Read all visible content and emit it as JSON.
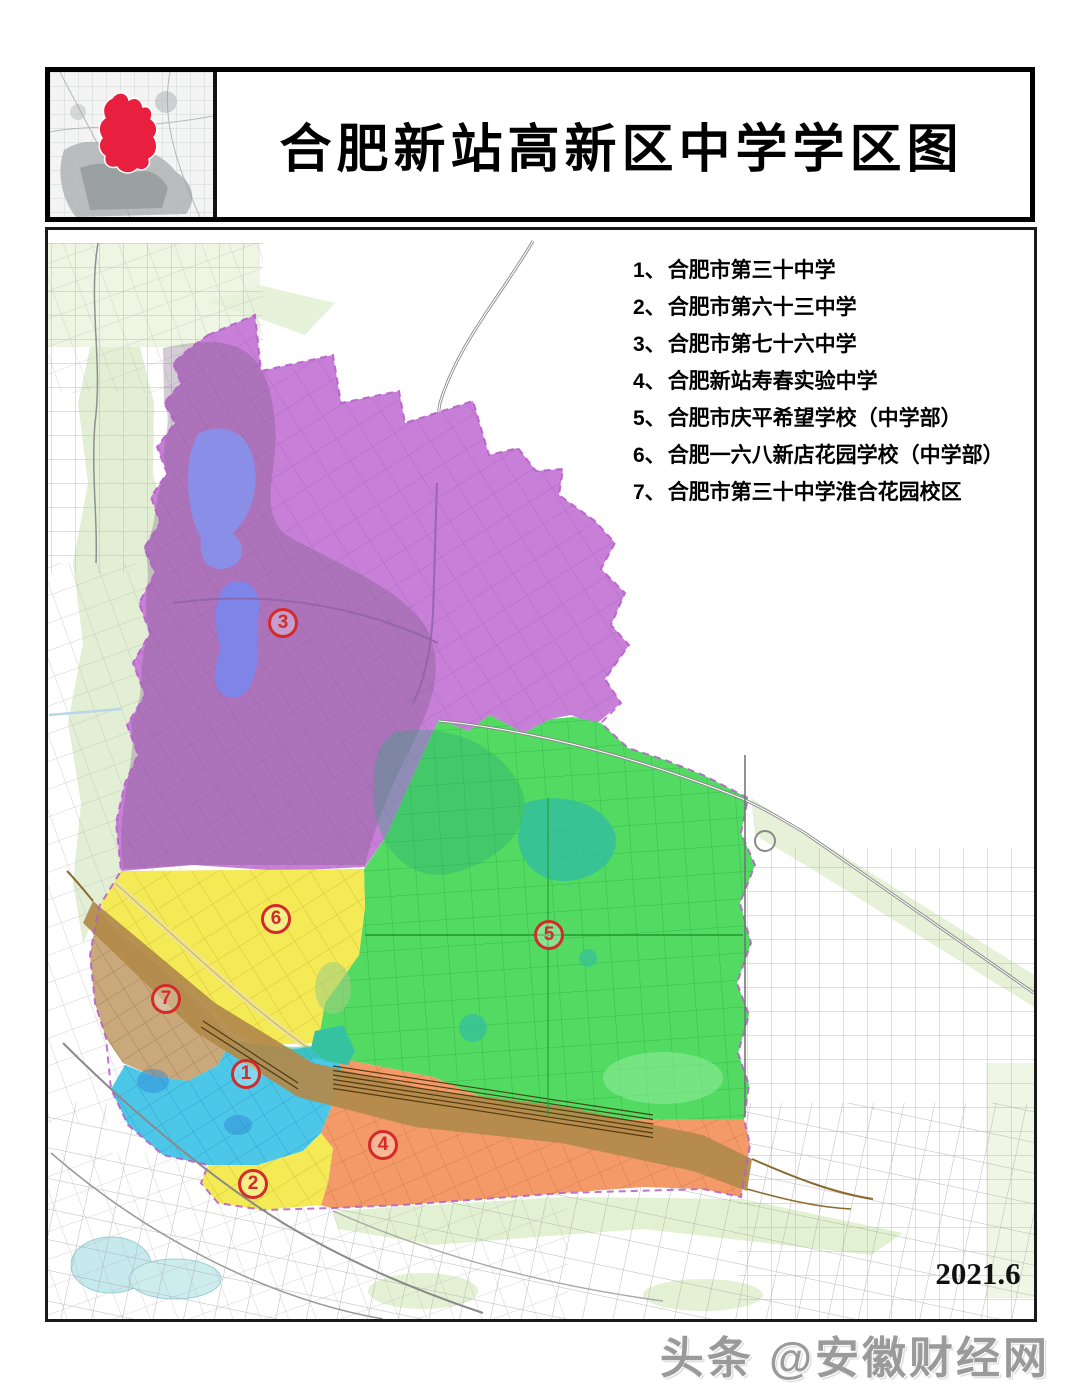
{
  "header": {
    "title": "合肥新站高新区中学学区图"
  },
  "inset": {
    "description": "city locator inset",
    "highlight_color": "#e81f3e"
  },
  "legend": {
    "items": [
      {
        "num": "1、",
        "name": "合肥市第三十中学"
      },
      {
        "num": "2、",
        "name": "合肥市第六十三中学"
      },
      {
        "num": "3、",
        "name": "合肥市第七十六中学"
      },
      {
        "num": "4、",
        "name": "合肥新站寿春实验中学"
      },
      {
        "num": "5、",
        "name": "合肥市庆平希望学校（中学部）"
      },
      {
        "num": "6、",
        "name": "合肥一六八新店花园学校（中学部）"
      },
      {
        "num": "7、",
        "name": "合肥市第三十中学淮合花园校区"
      }
    ]
  },
  "map": {
    "date": "2021.6",
    "markers": [
      {
        "label": "1",
        "school": "合肥市第三十中学",
        "district_color": "#4cc7e8"
      },
      {
        "label": "2",
        "school": "合肥市第六十三中学",
        "district_color": "#f3ea55"
      },
      {
        "label": "3",
        "school": "合肥市第七十六中学",
        "district_color": "#c77fd7"
      },
      {
        "label": "4",
        "school": "合肥新站寿春实验中学",
        "district_color": "#f49a68"
      },
      {
        "label": "5",
        "school": "合肥市庆平希望学校（中学部）",
        "district_color": "#52da62"
      },
      {
        "label": "6",
        "school": "合肥一六八新店花园学校（中学部）",
        "district_color": "#f3ea55"
      },
      {
        "label": "7",
        "school": "合肥市第三十中学淮合花园校区",
        "district_color": "#c9a87b"
      }
    ],
    "colors": {
      "district_purple": "#c77fd7",
      "district_green": "#52da62",
      "district_yellow": "#f3ea55",
      "district_tan": "#c9a87b",
      "district_cyan": "#4cc7e8",
      "district_orange": "#f49a68",
      "railway_band": "#b28a4a",
      "boundary_dash": "#b55cc8",
      "marker_red": "#d42a2a",
      "lake_blue": "#8b8ee6",
      "pale_green": "#e2efd4"
    }
  },
  "watermark": {
    "text": "头条 @安徽财经网"
  }
}
